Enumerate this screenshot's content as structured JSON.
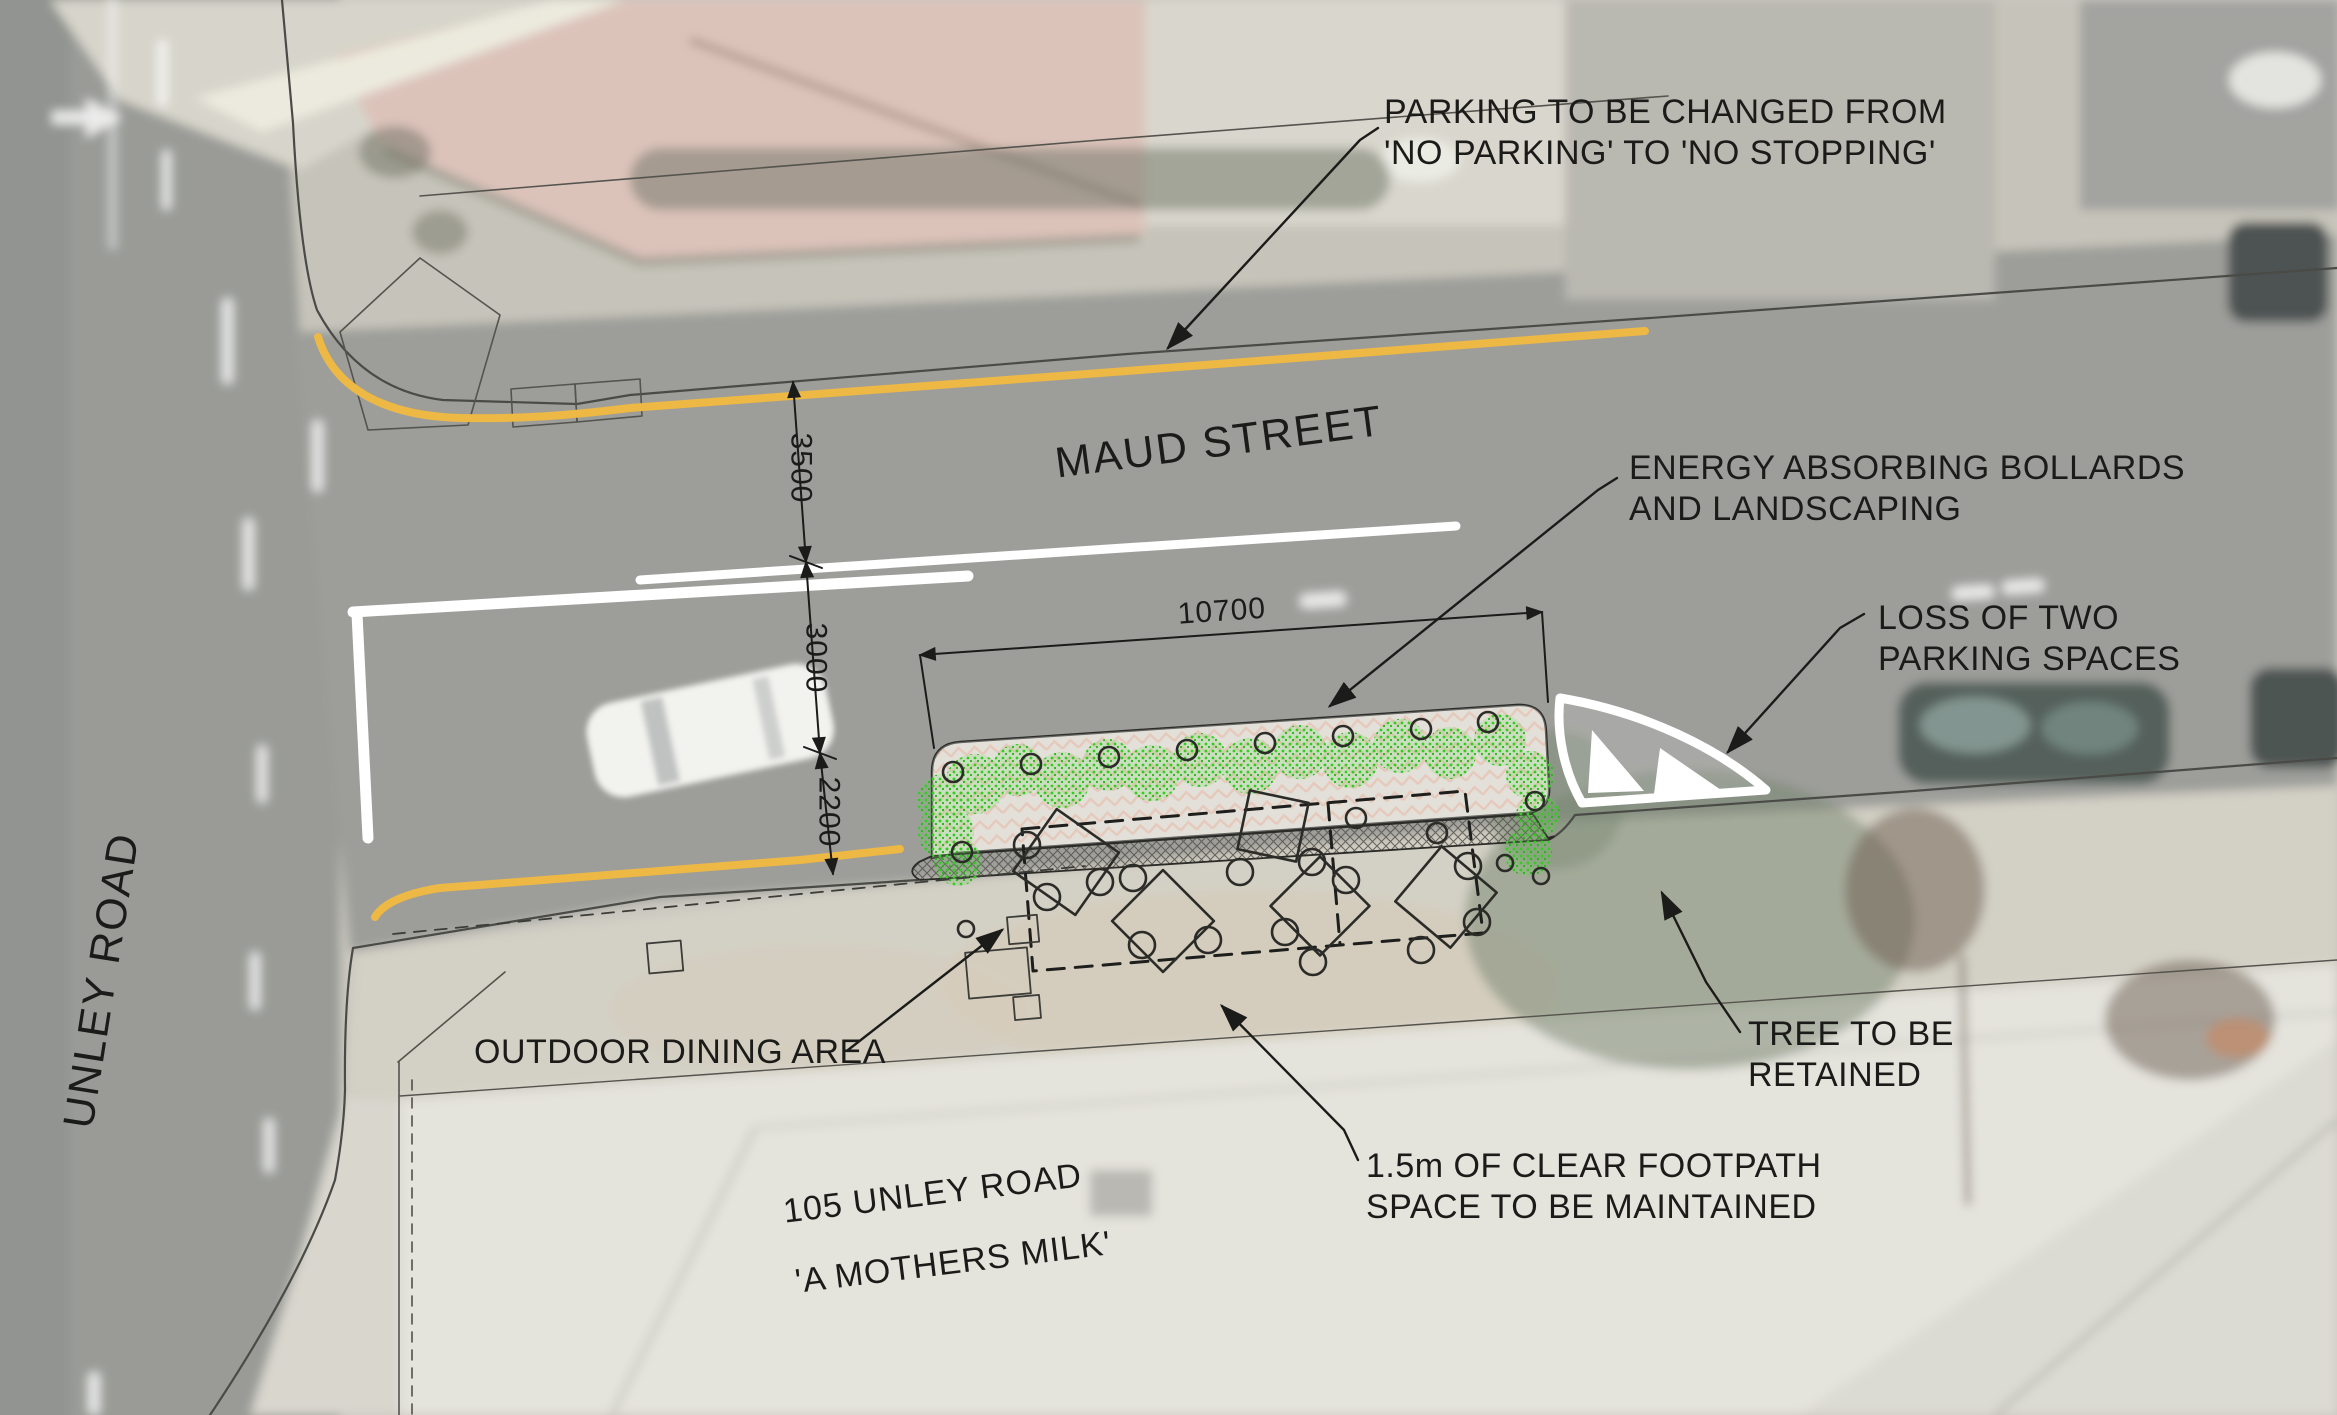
{
  "plan": {
    "title": "Outdoor dining area site plan",
    "streets": {
      "maud": "MAUD STREET",
      "unley": "UNLEY ROAD"
    },
    "site": {
      "address": "105 UNLEY ROAD",
      "business": "'A MOTHERS MILK'"
    },
    "annotations": {
      "parking_change": "PARKING TO BE CHANGED FROM\n'NO PARKING' TO 'NO STOPPING'",
      "bollards": "ENERGY ABSORBING BOLLARDS\nAND LANDSCAPING",
      "parking_loss": "LOSS OF TWO\nPARKING SPACES",
      "outdoor_dining": "OUTDOOR DINING AREA",
      "tree": "TREE TO BE\nRETAINED",
      "footpath": "1.5m OF CLEAR FOOTPATH\nSPACE TO BE MAINTAINED"
    },
    "dimensions": {
      "d3500": "3500",
      "d3000": "3000",
      "d2200": "2200",
      "d10700": "10700"
    },
    "colors": {
      "yellow_line": "#EDB844",
      "shrub_green": "#35CC22",
      "paving_pink": "#DD9B80",
      "hatch_grey": "#56524C",
      "ink": "#1B1B19"
    }
  }
}
